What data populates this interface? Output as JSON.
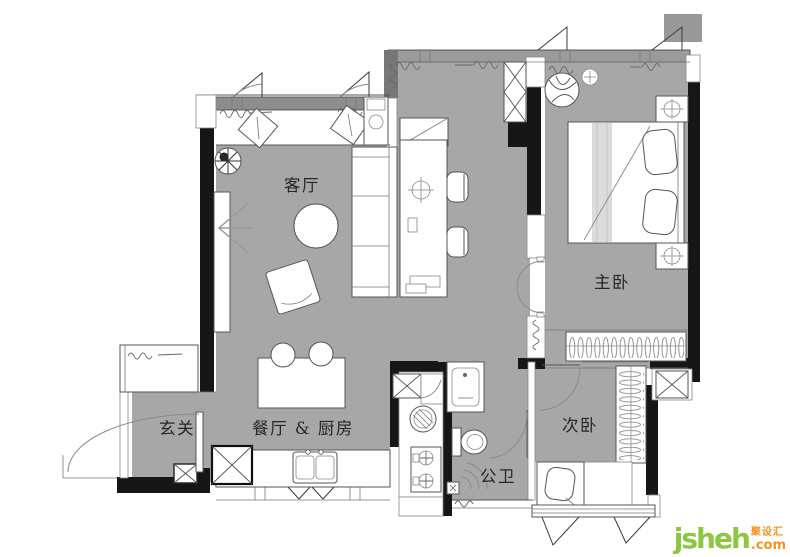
{
  "canvas": {
    "width": 790,
    "height": 557,
    "background": "#ffffff"
  },
  "floor_plan": {
    "type": "apartment-floor-plan",
    "rooms": [
      {
        "id": "living-room",
        "label": "客厅"
      },
      {
        "id": "master-bedroom",
        "label": "主卧"
      },
      {
        "id": "second-bedroom",
        "label": "次卧"
      },
      {
        "id": "entrance",
        "label": "玄关"
      },
      {
        "id": "dining-kitchen",
        "label": "餐厅 & 厨房"
      },
      {
        "id": "bathroom",
        "label": "公卫"
      }
    ],
    "colors": {
      "floor_gray": "#a7a7a7",
      "wall_black": "#161616",
      "window_track_gray": "#8d8d8d",
      "furniture_outline": "#555555"
    }
  },
  "watermark": {
    "brand": "jsheh",
    "tld": ".com",
    "cjk_name": "聚设汇",
    "brand_color": "#8dc63f",
    "accent_color": "#f6921e"
  }
}
